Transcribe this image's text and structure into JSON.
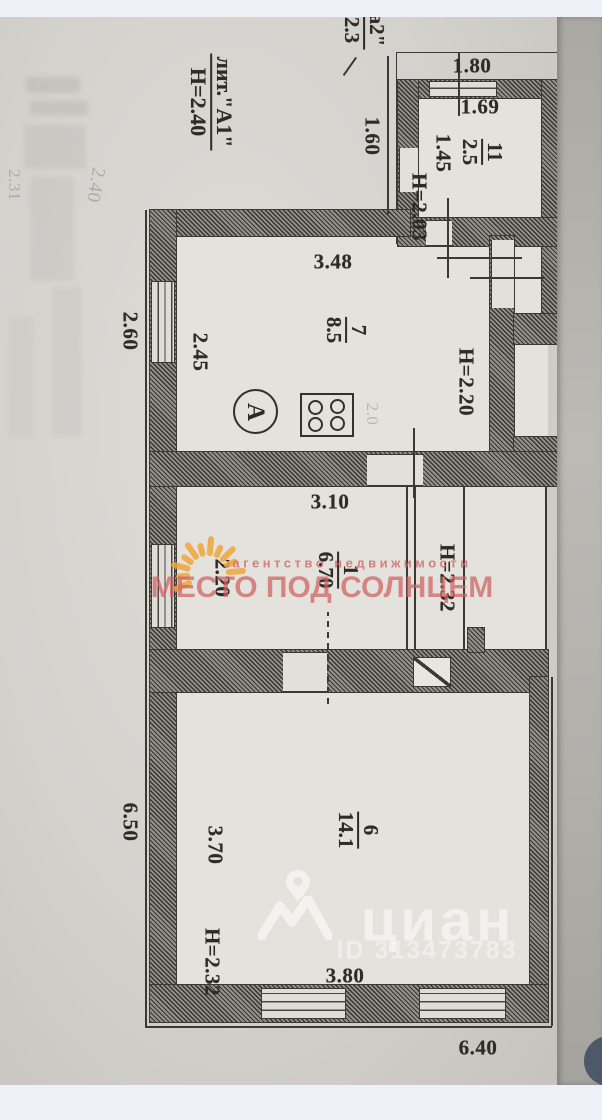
{
  "floorplan": {
    "liter": {
      "label": "лит.\"А1\"",
      "height": "Н=2.40"
    },
    "corner_note": {
      "top": "а2\"",
      "bottom": "2.3"
    },
    "rooms": [
      {
        "id": "room-11",
        "number": "11",
        "area": "2.5"
      },
      {
        "id": "room-7",
        "number": "7",
        "area": "8.5"
      },
      {
        "id": "room-1",
        "number": "1",
        "area": "6.70"
      },
      {
        "id": "room-6",
        "number": "6",
        "area": "14.1"
      }
    ],
    "dims": {
      "top_outer": "1.80",
      "top_inner": "1.69",
      "porch_side": "1.45",
      "porch_height": "Н=2.03",
      "porch_left": "1.60",
      "kitchen_width": "3.48",
      "kitchen_depth": "2.45",
      "kitchen_left_outer": "2.60",
      "hall_height": "Н=2.20",
      "mid_width": "3.10",
      "mid_depth": "2.20",
      "mid_height": "Н=2.32",
      "room6_depth": "3.70",
      "room6_left_outer": "6.50",
      "room6_height": "Н=2.32",
      "room6_width": "3.80",
      "bottom_outer": "6.40"
    },
    "letter_a": "А",
    "pencil_notes": {
      "a": "2.40",
      "b": "2.31",
      "c": "2.0"
    }
  },
  "watermarks": {
    "agency": {
      "line1": "агентство недвижимости",
      "line2": "МЕСТО ПОД СОЛНЦЕМ",
      "text_color": "#d26a6a",
      "sun_color": "#f0a63c"
    },
    "cian": {
      "logo_text": "циан",
      "id_text": "ID 313473783",
      "color": "#ffffff"
    }
  },
  "ui": {
    "fab_color": "#4d5869"
  }
}
